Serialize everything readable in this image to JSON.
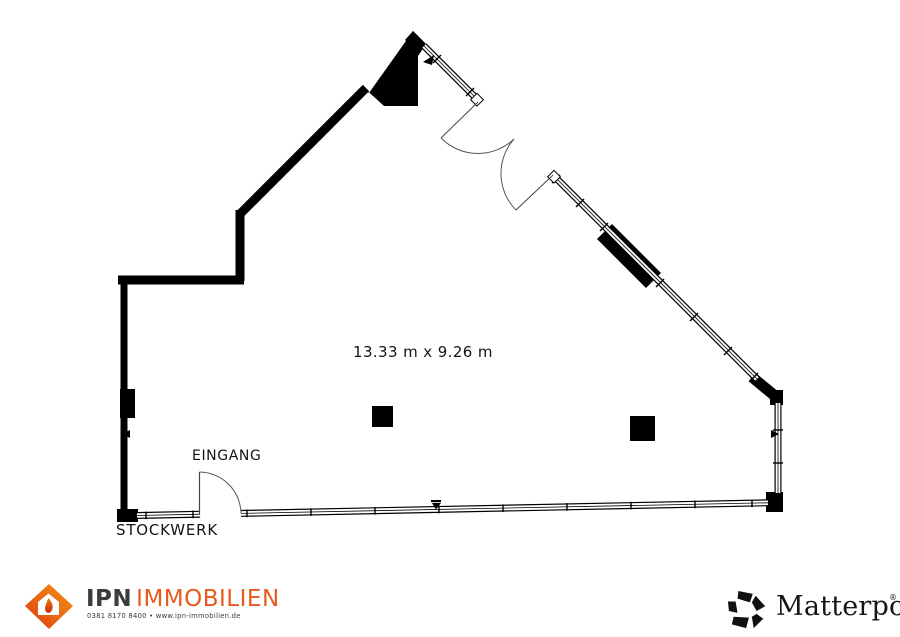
{
  "plan": {
    "dimension_label": "13.33 m x 9.26 m",
    "entrance_label": "EINGANG",
    "floor_label": "STOCKWERK"
  },
  "footer": {
    "ipn": {
      "brand_primary": "IPN",
      "brand_secondary": "IMMOBILIEN",
      "contact": "0381 8170 8400  •  www.ipn-immobilien.de",
      "accent_color": "#E85A1C",
      "text_color": "#3C3C3B",
      "logo_icon": "ipn-diamond-house-icon"
    },
    "matterport": {
      "name": "Matterport",
      "trademark": "®",
      "color": "#161616",
      "logo_icon": "matterport-pinwheel-icon"
    }
  },
  "colors": {
    "background": "#FFFFFF",
    "wall": "#000000",
    "window_line": "#1c1c1c"
  }
}
